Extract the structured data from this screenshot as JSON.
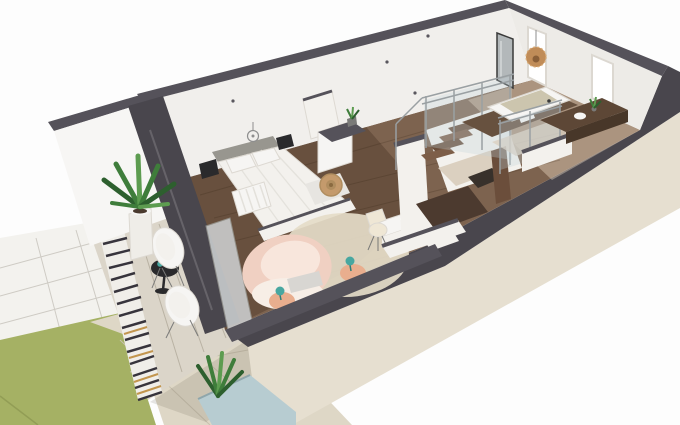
{
  "scene": {
    "kind": "3d-floorplan-cutaway-render",
    "view": "high-angle isometric, building oriented diagonally lower-left to upper-right",
    "width_px": 680,
    "height_px": 425
  },
  "areas": {
    "bedroom": {
      "name": "bedroom",
      "furniture": [
        "double-bed",
        "gray-headboard",
        "two-pillows",
        "quilted-duvet",
        "wall-mounted-nightstand-left",
        "wall-mounted-nightstand-right",
        "wire-pendant-light",
        "white-radiator",
        "rattan-hoop-decor",
        "white-wardrobe",
        "low-foot-wall"
      ]
    },
    "lounge": {
      "name": "lounge-corner",
      "furniture": [
        "blush-pink-armchair",
        "round-jute-rug",
        "terracotta-side-table-with-teal-lamp",
        "second-terracotta-side-table-with-teal-lamp",
        "white-desk",
        "cream-desk-chair"
      ]
    },
    "stairwell": {
      "name": "stairwell",
      "features": [
        "wooden-stairs-descending",
        "glass-and-steel-railing",
        "white-half-walls",
        "lower-corridor",
        "floor-opening",
        "wood-panel"
      ]
    },
    "bathroom": {
      "name": "bathroom",
      "features": [
        "bathtub-on-dark-wood-platform",
        "glass-screen-railing",
        "leaning-mirror",
        "rattan-ball-pendant",
        "two-windows",
        "dark-wood-vanity-with-plant"
      ]
    },
    "balcony": {
      "name": "balcony",
      "features": [
        "slatted-privacy-screen",
        "plank-floor",
        "black-bistro-table",
        "two-white-shell-chairs",
        "potted-palm"
      ]
    },
    "exterior": {
      "name": "garden",
      "features": [
        "green-lawn",
        "white-paved-path",
        "stone-terrace",
        "plunge-pool",
        "pool-side-plant",
        "beige-facade"
      ]
    }
  },
  "palette": {
    "bg": "#fdfdfd",
    "cap": "#55525a",
    "wall": "#f1efec",
    "wall_r": "#edebe7",
    "wall_out": "#f7f6f4",
    "facade": "#e6dfd0",
    "floor": "#7d634f",
    "floor_dark": "rgba(56,36,24,0.30)",
    "floor_light": "rgba(246,230,206,0.38)",
    "seam": "rgba(45,28,16,0.20)",
    "win": "#ffffff",
    "frame": "#dcd8d1",
    "mirror": "#b3b8ba",
    "mirror_dk": "#3a3a3a",
    "hl": "rgba(255,255,255,0.45)",
    "band": "#49464d",
    "pane": "#d0d3d5",
    "pane_edge": "#9a9a94",
    "balcony": "#dbd5c9",
    "b_seam": "#b9b2a3",
    "rail_light": "#f0eee9",
    "rail_dark": "#37343c",
    "rail_wood": "#c2954e",
    "lawn": "#a5b164",
    "lawn_ln": "#8a9550",
    "terrace": "#ded7c6",
    "t_seam": "#c8c0ae",
    "shadow": "rgba(70,60,50,0.13)",
    "pave": "#f3f2ee",
    "p_seam": "#cecbc4",
    "pool": "#b7ccd1",
    "pool_edge": "#8fa6ab",
    "green": "#3f7d3b",
    "green_dk": "#2d5f2e",
    "green_lt": "#5d9c50",
    "pot": "#efede8",
    "soil": "#4a3a2e",
    "white_soft": "#f6f5f3",
    "white_warm": "#f3f1ed",
    "edge": "#ddd9d2",
    "headboard": "#98968f",
    "quilt": "#e4e2dc",
    "throw": "#e7e5e1",
    "black_f": "#2a2a2c",
    "wire": "#8e8e8e",
    "rad_fin": "#e3e1db",
    "jute": "#c49a6c",
    "jute_mid": "#b08d5f",
    "jute_dk": "#8a6a40",
    "rug": "#e5dcc8",
    "pink": "#f0d0c2",
    "pink_lt": "#f8e6dc",
    "slip": "#f7eee6",
    "gray_c": "#d8d6d2",
    "peach": "#e9ae8e",
    "teal": "#48a7a0",
    "teal_dk": "#2f7d77",
    "cream": "#efe7d5",
    "leg": "#7a7a78",
    "rail_m": "#9aa0a3",
    "glass": "rgba(195,212,218,0.30)",
    "tread_a": "#6b4f3c",
    "tread_b": "#7d5e48",
    "corridor": "#4c3a2f",
    "landing": "#dbd0c0",
    "opening": "#38312b",
    "panel": "#6b4e3b",
    "platform": "#67513f",
    "tub_mat": "#ccc5ae",
    "vanity": "#5d4736",
    "vanity_f": "#483729",
    "rattan": "#c08c58",
    "rattan_hole": "#8a5f38",
    "rattan_ring": "#d9ab76",
    "dot": "#5a575e"
  }
}
